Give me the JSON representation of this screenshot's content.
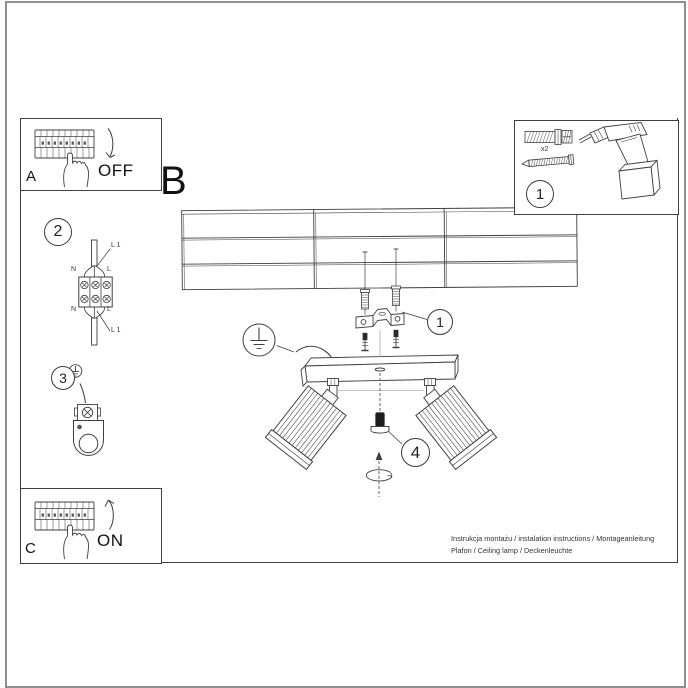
{
  "manual": {
    "steps": {
      "a": "A",
      "b": "B",
      "c": "C"
    },
    "switch": {
      "off": "OFF",
      "on": "ON"
    },
    "callouts": {
      "tools": "1",
      "anchor": "1",
      "connector": "2",
      "ground": "3",
      "adjust": "4"
    },
    "tools": {
      "quantity": "x2"
    },
    "connector_labels": {
      "l1_top": "L 1",
      "n_top": "N",
      "l_top": "L",
      "n_bottom": "N",
      "l_bottom": "L",
      "l1_bottom": "L 1"
    },
    "footer": {
      "line1": "Instrukcja montażu / instalation instructions / Montageanleitung",
      "line2": "Plafon / Ceiling lamp / Deckenleuchte"
    },
    "colors": {
      "ink": "#3f3f3f",
      "frame": "#8f8f8f",
      "text": "#111111"
    }
  }
}
